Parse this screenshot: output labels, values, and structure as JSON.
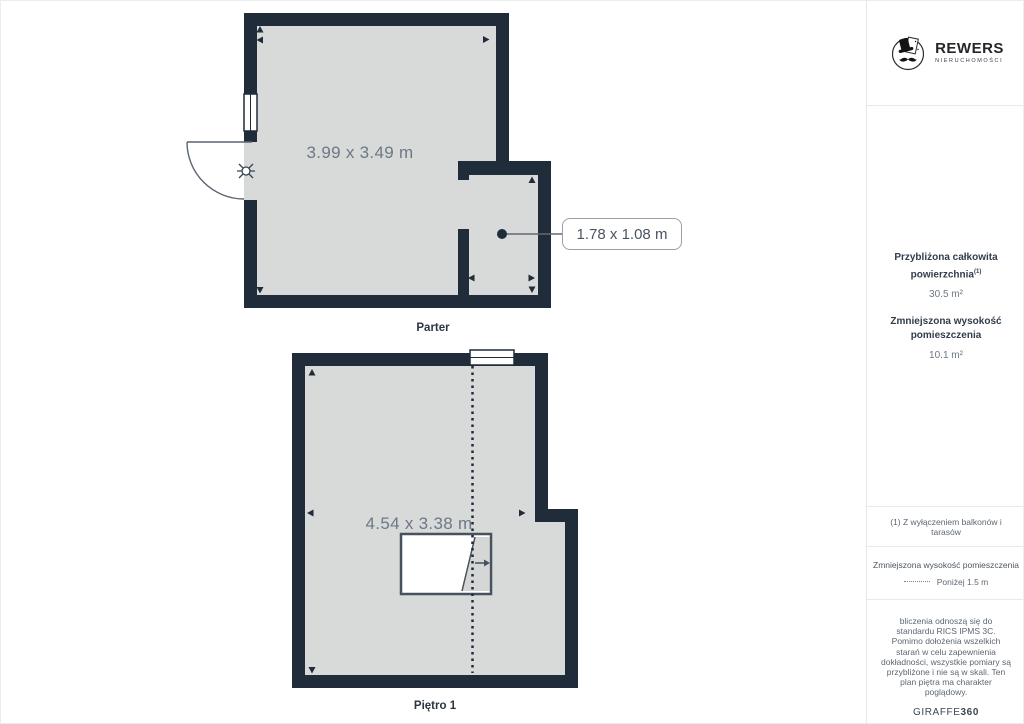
{
  "branding": {
    "logo_title": "REWERS",
    "logo_subtitle": "NIERUCHOMOŚCI",
    "footer_brand": "GIRAFFE",
    "footer_brand_bold": "360"
  },
  "sidebar": {
    "total_area_label": "Przybliżona całkowita powierzchnia",
    "total_area_sup": "(1)",
    "total_area_value": "30.5 m²",
    "reduced_height_label": "Zmniejszona wysokość pomieszczenia",
    "reduced_height_value": "10.1 m²",
    "footnote": "(1) Z wyłączeniem balkonów i tarasów",
    "legend_title": "Zmniejszona wysokość pomieszczenia",
    "legend_item": "Poniżej 1.5 m",
    "disclaimer": "bliczenia odnoszą się do standardu RICS IPMS 3C. Pomimo dołożenia wszelkich starań w celu zapewnienia dokładności, wszystkie pomiary są przybliżone i nie są w skali. Ten plan piętra ma charakter poglądowy."
  },
  "floors": [
    {
      "name": "Parter",
      "room_dimension": "3.99 x 3.49 m",
      "callout_dimension": "1.78 x 1.08 m"
    },
    {
      "name": "Piętro 1",
      "room_dimension": "4.54 x 3.38 m"
    }
  ],
  "colors": {
    "wall": "#212c3a",
    "floor": "#d8d9d9",
    "dimension_text": "#6d7886"
  }
}
